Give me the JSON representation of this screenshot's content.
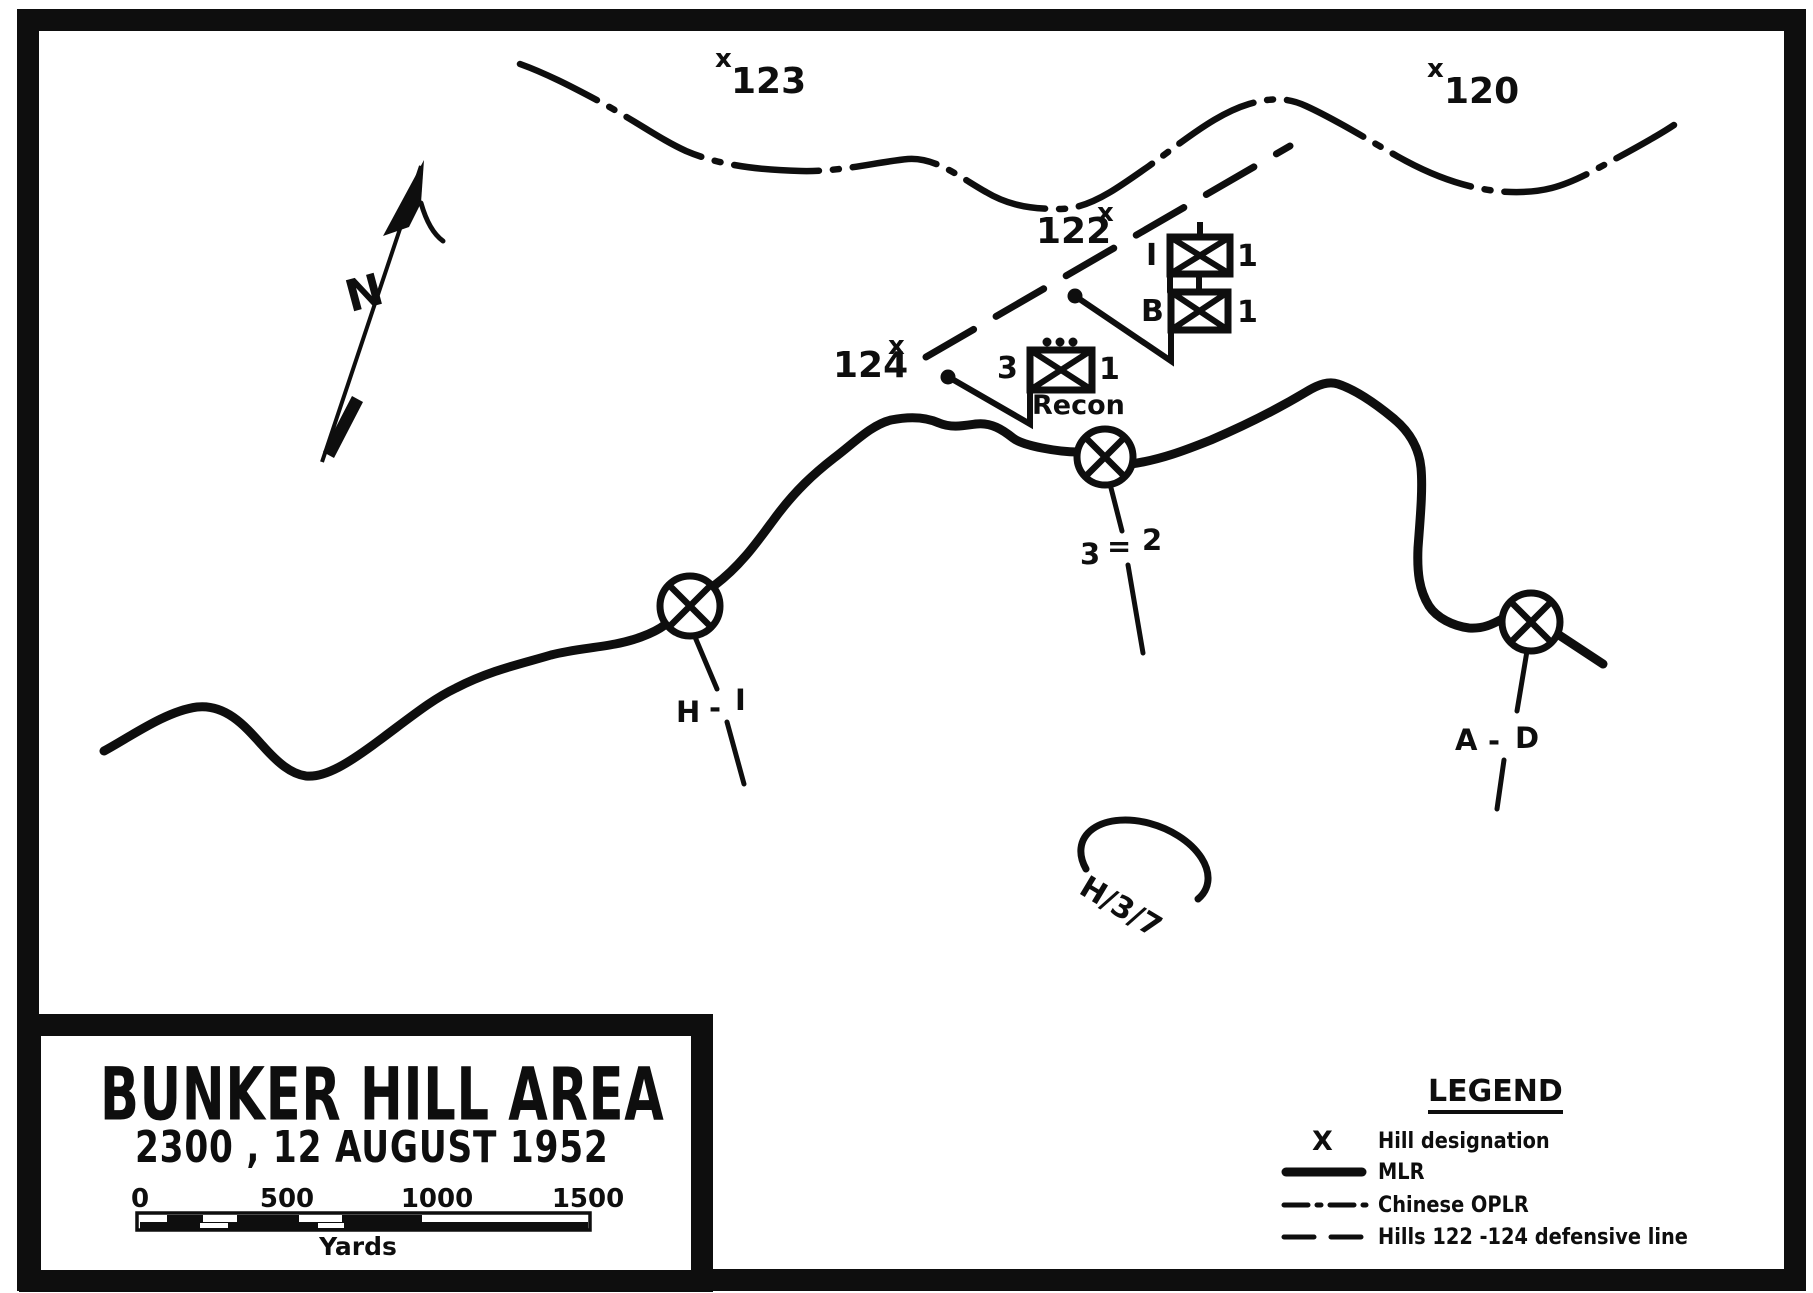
{
  "colors": {
    "ink": "#0e0e0e",
    "paper": "#ffffff"
  },
  "compass": {
    "label": "N"
  },
  "hills": [
    {
      "marker": "x",
      "name": "123"
    },
    {
      "marker": "x",
      "name": "120"
    },
    {
      "marker": "x",
      "name": "122"
    },
    {
      "marker": "x",
      "name": "124"
    }
  ],
  "units": [
    {
      "left": "I",
      "right": "1"
    },
    {
      "left": "B",
      "right": "1"
    },
    {
      "left": "3",
      "right": "1",
      "caption": "Recon"
    }
  ],
  "boundaries": [
    {
      "a": "H",
      "sep": "-",
      "b": "I"
    },
    {
      "a": "3",
      "sep": "=",
      "b": "2"
    },
    {
      "a": "A",
      "sep": "-",
      "b": "D"
    }
  ],
  "area_label": {
    "text": "H/3/7"
  },
  "title_block": {
    "title": "BUNKER HILL AREA",
    "datetime": "2300 , 12 AUGUST 1952",
    "scale_ticks": [
      "0",
      "500",
      "1000",
      "1500"
    ],
    "scale_unit": "Yards"
  },
  "legend": {
    "heading": "LEGEND",
    "items": [
      {
        "glyph": "X",
        "label": "Hill designation"
      },
      {
        "glyph": "",
        "label": "MLR"
      },
      {
        "glyph": "",
        "label": "Chinese OPLR"
      },
      {
        "glyph": "",
        "label": "Hills 122 -124 defensive line"
      }
    ]
  }
}
